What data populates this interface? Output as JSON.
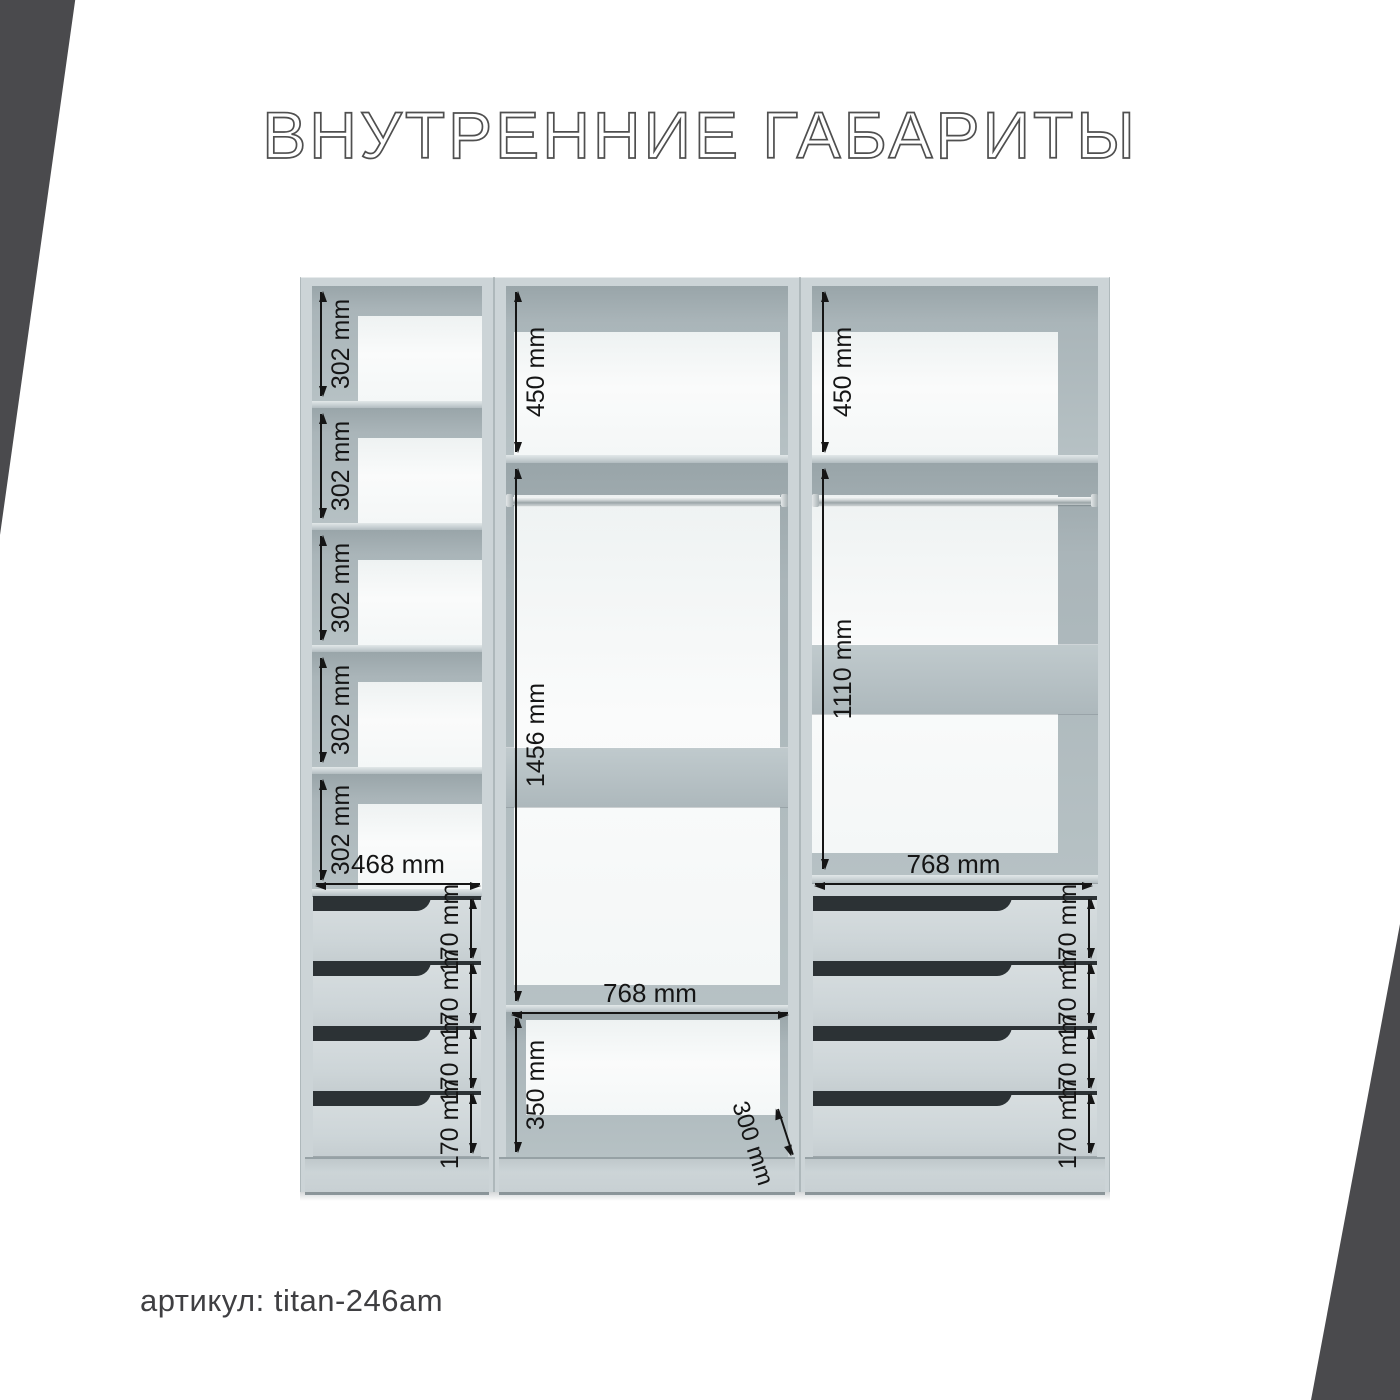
{
  "title": "ВНУТРЕННИЕ ГАБАРИТЫ",
  "footer": {
    "article_label": "артикул: titan-246am"
  },
  "dimensions": {
    "left_column": {
      "shelves": [
        "302 mm",
        "302 mm",
        "302 mm",
        "302 mm",
        "302 mm"
      ],
      "inner_width": "468 mm",
      "drawers": [
        "170 mm",
        "170 mm",
        "170 mm",
        "170 mm"
      ]
    },
    "middle_column": {
      "top_shelf_height": "450 mm",
      "hanging_height": "1456 mm",
      "inner_width": "768 mm",
      "bottom_shelf_height": "350 mm",
      "bottom_shelf_depth": "300 mm"
    },
    "right_column": {
      "top_shelf_height": "450 mm",
      "hanging_height": "1110 mm",
      "inner_width": "768 mm",
      "drawers": [
        "170 mm",
        "170 mm",
        "170 mm",
        "170 mm"
      ]
    }
  },
  "colors": {
    "corner_wedge": "#4a4a4d",
    "cabinet_body": "#ccd4d7",
    "dimension_ink": "#151515",
    "title_outline": "#4f4f4f"
  }
}
